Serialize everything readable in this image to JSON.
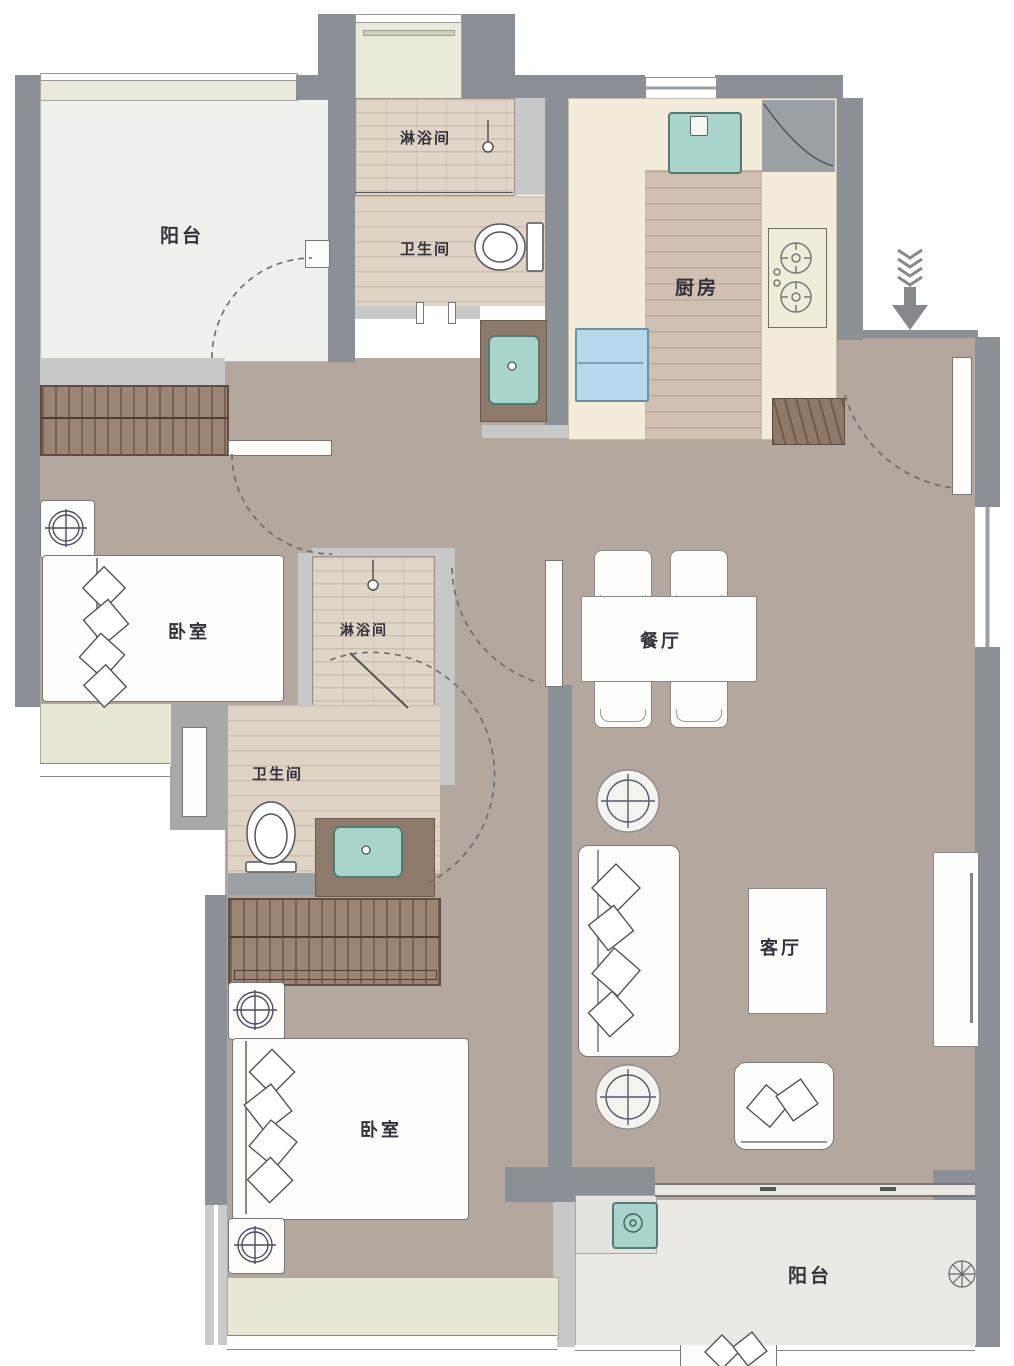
{
  "floorplan": {
    "rooms": {
      "balcony_north": "阳台",
      "shower_north": "淋浴间",
      "bath_north": "卫生间",
      "kitchen": "厨房",
      "bedroom_west": "卧室",
      "shower_mid": "淋浴间",
      "bath_mid": "卫生间",
      "dining": "餐厅",
      "living": "客厅",
      "bedroom_south": "卧室",
      "balcony_south": "阳台"
    },
    "icons": {
      "entry_arrow": "down-arrow"
    },
    "colors": {
      "wall": "#8b9096",
      "wall_light": "#c7c9c8",
      "floor": "#b4a89e",
      "counter": "#f4ecda",
      "wood": "#cfc0b1",
      "fixture_teal": "#a9d4cb",
      "fridge_blue": "#b5d8ec",
      "balcony_white": "#f0f0ed",
      "window_sill": "#e9ead9",
      "bath_floor": "#ded3c5",
      "wardrobe_brown": "#9b8474",
      "label_text": "#32323c"
    }
  }
}
